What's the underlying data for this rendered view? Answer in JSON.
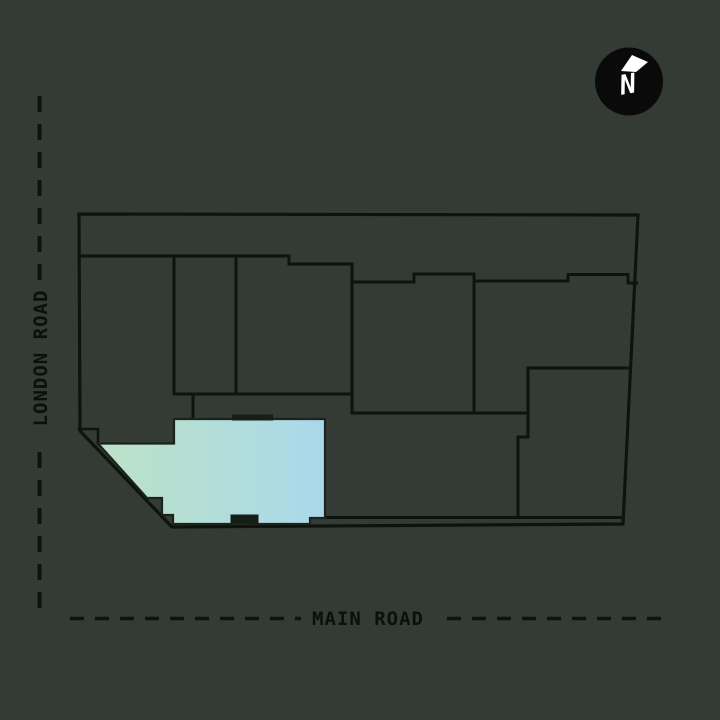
{
  "plan": {
    "left_road_label": "LONDON ROAD",
    "bottom_road_label": "MAIN ROAD",
    "compass_label": "N"
  },
  "colors": {
    "background": "#343B35",
    "line": "#0E130E",
    "road_text": "#0B100B",
    "unit_fill_start": "#BCE2C6",
    "unit_fill_end": "#AAD8EB",
    "unit_border": "#1C231D",
    "entrance_marker": "#171D17",
    "compass_circle": "#0A0A0A",
    "compass_text": "#FFFFFF"
  }
}
